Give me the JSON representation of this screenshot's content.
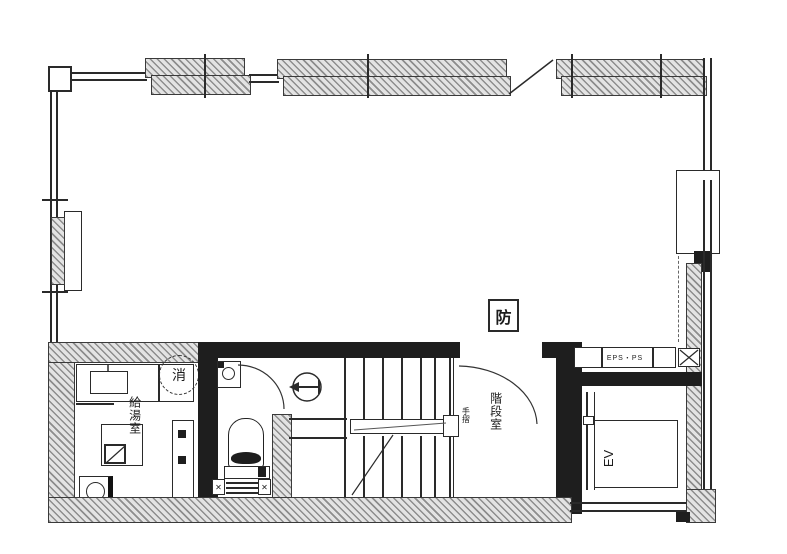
{
  "drawing": {
    "type": "architectural-floor-plan",
    "labels": {
      "fire_shutter_marker": "防",
      "fire_extinguisher": "消",
      "kitchenette_room": "給湯室",
      "stairwell_room": "階段室",
      "handrail": "手摺",
      "elevator": "EV",
      "pipe_shaft": "EPS・PS"
    },
    "icons": {
      "vent_cross": "✕"
    },
    "colors": {
      "line": "#2a2a2a",
      "wall_fill": "#1e1e1e",
      "hatch_gray": "#8d8d8d",
      "background": "#ffffff"
    }
  }
}
